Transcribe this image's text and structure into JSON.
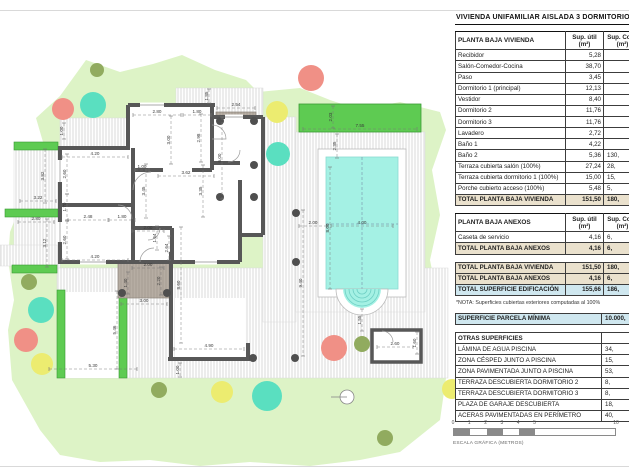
{
  "title": "VIVIENDA UNIFAMILIAR AISLADA 3 DORMITORIOS",
  "palette": {
    "lawn": "#ddf3c6",
    "bright_green": "#5ecb52",
    "bright_green_border": "#3a9a34",
    "deck_fill": "#fefefe",
    "deck_line": "#cccccc",
    "covered_fill": "#b6ada3",
    "covered_line": "#a0968c",
    "wall": "#575757",
    "pool_water": "#a4f1e4",
    "pool_step": "#6ecfc4",
    "tree_olive": "#91ab5f",
    "tree_salmon": "#f09086",
    "tree_teal": "#5adfc0",
    "tree_yellow": "#ecec70",
    "total_beige": "#eae1cd",
    "total_blue": "#cfe7ef",
    "dim_text": "#3a3a3a"
  },
  "tables": {
    "vivienda": {
      "header": [
        "PLANTA BAJA VIVIENDA",
        "Sup. útil (m²)",
        "Sup. Cons (m²)"
      ],
      "rows": [
        {
          "c": [
            "Recibidor",
            "5,28",
            ""
          ]
        },
        {
          "c": [
            "Salón-Comedor-Cocina",
            "38,70",
            ""
          ]
        },
        {
          "c": [
            "Paso",
            "3,45",
            ""
          ]
        },
        {
          "c": [
            "Dormitorio 1 (principal)",
            "12,13",
            ""
          ]
        },
        {
          "c": [
            "Vestidor",
            "8,40",
            ""
          ]
        },
        {
          "c": [
            "Dormitorio 2",
            "11,76",
            ""
          ]
        },
        {
          "c": [
            "Dormitorio 3",
            "11,76",
            ""
          ]
        },
        {
          "c": [
            "Lavadero",
            "2,72",
            ""
          ]
        },
        {
          "c": [
            "Baño 1",
            "4,22",
            ""
          ]
        },
        {
          "c": [
            "Baño 2",
            "5,36",
            "130,"
          ]
        },
        {
          "c": [
            "Terraza cubierta salón (100%)",
            "27,24",
            "28,"
          ]
        },
        {
          "c": [
            "Terraza cubierta dormitorio 1 (100%)",
            "15,00",
            "15,"
          ]
        },
        {
          "c": [
            "Porche cubierto acceso (100%)",
            "5,48",
            "5,"
          ]
        },
        {
          "c": [
            "TOTAL PLANTA BAJA VIVIENDA",
            "151,50",
            "180,"
          ],
          "s": "beige"
        }
      ]
    },
    "anexos": {
      "header": [
        "PLANTA BAJA ANEXOS",
        "Sup. útil (m²)",
        "Sup. Cons (m²)"
      ],
      "rows": [
        {
          "c": [
            "Caseta de servicio",
            "4,16",
            "6,"
          ]
        },
        {
          "c": [
            "TOTAL PLANTA BAJA ANEXOS",
            "4,16",
            "6,"
          ],
          "s": "beige"
        }
      ]
    },
    "resumen": {
      "rows": [
        {
          "c": [
            "TOTAL PLANTA BAJA VIVIENDA",
            "151,50",
            "180,"
          ],
          "s": "beige"
        },
        {
          "c": [
            "TOTAL PLANTA BAJA ANEXOS",
            "4,16",
            "6,"
          ],
          "s": "beige"
        },
        {
          "c": [
            "TOTAL SUPERFICIE EDIFICACIÓN",
            "155,66",
            "186,"
          ],
          "s": "blue"
        }
      ]
    },
    "nota": "*NOTA: Superficies cubiertas exteriores computadas al 100%",
    "parcela": {
      "rows": [
        {
          "c": [
            "SUPERFICIE PARCELA MÍNIMA",
            "10.000,"
          ],
          "s": "blue"
        }
      ]
    },
    "otras": {
      "rows": [
        {
          "c": [
            "OTRAS SUPERFICIES",
            ""
          ],
          "s": "bold"
        },
        {
          "c": [
            "LÁMINA DE AGUA PISCINA",
            "34,"
          ]
        },
        {
          "c": [
            "ZONA CÉSPED JUNTO A PISCINA",
            "15,"
          ]
        },
        {
          "c": [
            "ZONA PAVIMENTADA JUNTO A PISCINA",
            "53,"
          ]
        },
        {
          "c": [
            "TERRAZA DESCUBIERTA DORMITORIO 2",
            "8,"
          ]
        },
        {
          "c": [
            "TERRAZA DESCUBIERTA DORMITORIO 3",
            "8,"
          ]
        },
        {
          "c": [
            "PLAZA DE GARAJE DESCUBIERTA",
            "18,"
          ]
        },
        {
          "c": [
            "ACERAS PAVIMENTADAS EN PERÍMETRO",
            "40,"
          ]
        }
      ]
    }
  },
  "scalebar": {
    "ticks": [
      "0",
      "1",
      "2",
      "3",
      "4",
      "5",
      "10"
    ],
    "values": [
      0,
      1,
      2,
      3,
      4,
      5,
      10
    ],
    "meters_per_bar": 10,
    "label": "ESCALA GRÁFICA (METROS)"
  },
  "plan": {
    "dimensions": [
      {
        "t": "1.00",
        "x": 64,
        "y": 131,
        "v": 1,
        "len": 16
      },
      {
        "t": "2.80",
        "x": 157,
        "y": 113,
        "len": 48
      },
      {
        "t": "1.80",
        "x": 197,
        "y": 113,
        "len": 28
      },
      {
        "t": "3.00",
        "x": 171,
        "y": 140,
        "v": 1,
        "len": 48
      },
      {
        "t": "2.98",
        "x": 201,
        "y": 138,
        "v": 1,
        "len": 48
      },
      {
        "t": "1.85",
        "x": 209,
        "y": 96,
        "v": 1,
        "len": 14
      },
      {
        "t": "2.54",
        "x": 236,
        "y": 106,
        "len": 38
      },
      {
        "t": "6.00",
        "x": 222,
        "y": 158,
        "v": 1,
        "len": 82
      },
      {
        "t": "4.20",
        "x": 95,
        "y": 155,
        "len": 66
      },
      {
        "t": "2.60",
        "x": 67,
        "y": 174,
        "v": 1,
        "len": 40
      },
      {
        "t": "1.70",
        "x": 67,
        "y": 207,
        "v": 1,
        "len": 26
      },
      {
        "t": "2.48",
        "x": 88,
        "y": 218,
        "len": 40
      },
      {
        "t": "1.80",
        "x": 122,
        "y": 218,
        "len": 26
      },
      {
        "t": "2.60",
        "x": 67,
        "y": 240,
        "v": 1,
        "len": 38
      },
      {
        "t": "4.20",
        "x": 95,
        "y": 258,
        "len": 66
      },
      {
        "t": "1.00",
        "x": 142,
        "y": 168,
        "len": 14
      },
      {
        "t": "3.62",
        "x": 186,
        "y": 174,
        "len": 56
      },
      {
        "t": "3.45",
        "x": 146,
        "y": 191,
        "v": 1,
        "len": 54
      },
      {
        "t": "3.35",
        "x": 203,
        "y": 191,
        "v": 1,
        "len": 52
      },
      {
        "t": "2.00",
        "x": 148,
        "y": 229,
        "len": 32
      },
      {
        "t": "1.64",
        "x": 157,
        "y": 238,
        "v": 1,
        "len": 24
      },
      {
        "t": "2.64",
        "x": 169,
        "y": 248,
        "v": 1,
        "len": 24
      },
      {
        "t": "2.00",
        "x": 148,
        "y": 266,
        "len": 32
      },
      {
        "t": "2.20",
        "x": 161,
        "y": 281,
        "v": 1,
        "len": 28
      },
      {
        "t": "1.40",
        "x": 128,
        "y": 283,
        "v": 1,
        "len": 22
      },
      {
        "t": "3.00",
        "x": 144,
        "y": 302,
        "len": 46
      },
      {
        "t": "8.60",
        "x": 181,
        "y": 285,
        "v": 1,
        "len": 116
      },
      {
        "t": "3.12",
        "x": 47,
        "y": 243,
        "v": 1,
        "len": 48
      },
      {
        "t": "3.82",
        "x": 45,
        "y": 176,
        "v": 1,
        "len": 54
      },
      {
        "t": "3.22",
        "x": 38,
        "y": 199,
        "len": 36
      },
      {
        "t": "2.80",
        "x": 36,
        "y": 220,
        "len": 36
      },
      {
        "t": "5.46",
        "x": 117,
        "y": 330,
        "v": 1,
        "len": 78
      },
      {
        "t": "5.30",
        "x": 93,
        "y": 367,
        "len": 88
      },
      {
        "t": "4.90",
        "x": 209,
        "y": 347,
        "len": 70
      },
      {
        "t": "1.00",
        "x": 180,
        "y": 370,
        "v": 1,
        "len": 14
      },
      {
        "t": "7.55",
        "x": 360,
        "y": 127,
        "len": 114
      },
      {
        "t": "2.03",
        "x": 333,
        "y": 117,
        "v": 1,
        "len": 22
      },
      {
        "t": "2.35",
        "x": 337,
        "y": 146,
        "v": 1,
        "len": 24
      },
      {
        "t": "2.00",
        "x": 313,
        "y": 224,
        "len": 28
      },
      {
        "t": "4.00",
        "x": 362,
        "y": 224,
        "len": 62
      },
      {
        "t": "8.00",
        "x": 330,
        "y": 228,
        "v": 1,
        "len": 122
      },
      {
        "t": "9.40",
        "x": 303,
        "y": 283,
        "v": 1,
        "len": 146
      },
      {
        "t": "1.55",
        "x": 362,
        "y": 320,
        "v": 1,
        "len": 22
      },
      {
        "t": "2.60",
        "x": 395,
        "y": 345,
        "len": 36
      },
      {
        "t": "1.60",
        "x": 417,
        "y": 343,
        "v": 1,
        "len": 22
      }
    ]
  }
}
